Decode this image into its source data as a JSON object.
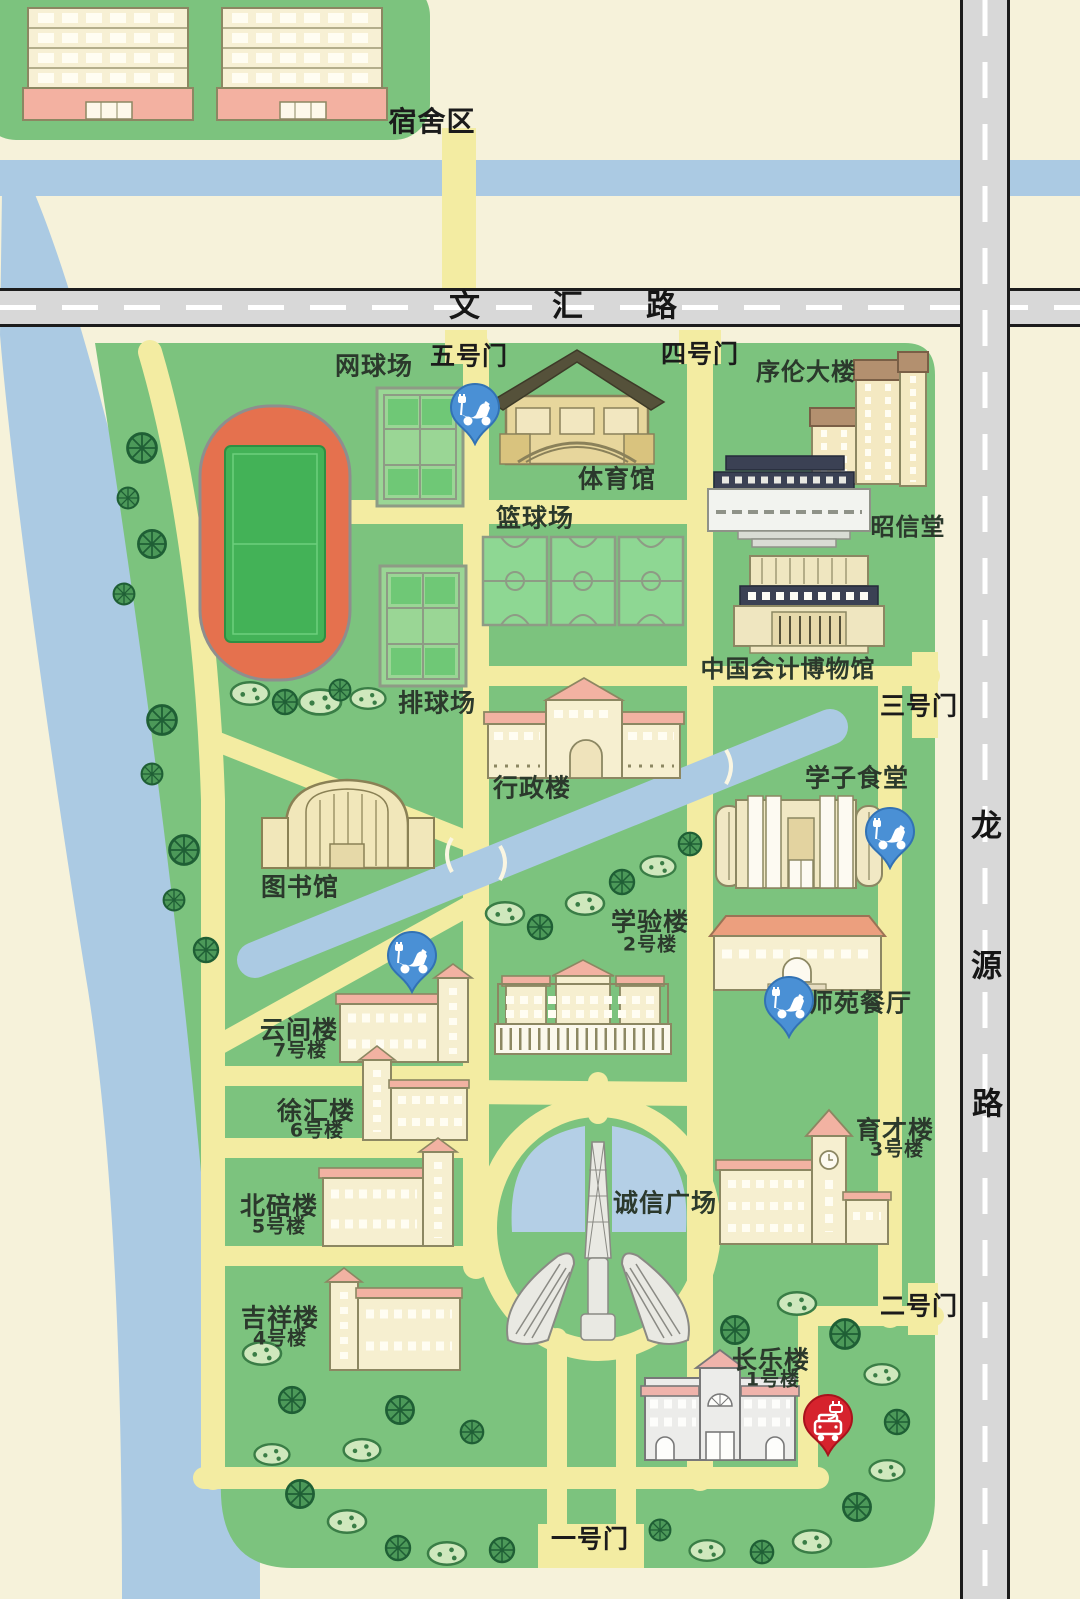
{
  "map": {
    "kind": "campus-map",
    "campus_sections": [
      "宿舍区"
    ],
    "roads": {
      "horizontal": "文汇路",
      "vertical": "龙源路"
    },
    "gates": [
      "一号门",
      "二号门",
      "三号门",
      "四号门",
      "五号门"
    ],
    "sports": [
      "网球场",
      "体育馆",
      "篮球场",
      "排球场"
    ],
    "buildings": [
      "序伦大楼",
      "昭信堂",
      "中国会计博物馆",
      "行政楼",
      "学子食堂",
      "图书馆",
      "学验楼 2号楼",
      "师苑餐厅",
      "云间楼 7号楼",
      "徐汇楼 6号楼",
      "北碚楼 5号楼",
      "吉祥楼 4号楼",
      "育才楼 3号楼",
      "诚信广场",
      "长乐楼 1号楼"
    ]
  },
  "colors": {
    "background_cream": "#f6f2da",
    "campus_green": "#7cc37e",
    "path_yellow": "#f3eca2",
    "river_blue": "#abcae3",
    "road_gray": "#d8d8d8",
    "road_border": "#1c1c1c",
    "track_orange": "#e5714e",
    "field_green": "#43b257",
    "court_green": "#9ad695",
    "building_cream": "#f6efd0",
    "roof_pink": "#f2b2a2",
    "roof_navy": "#3b4154",
    "pin_blue": "#4a90d5",
    "pin_red": "#d6232d",
    "label_color": "#2b392c"
  },
  "labels": [
    {
      "id": "dorm-area",
      "text": "宿舍区",
      "x": 432,
      "y": 122,
      "size": 28,
      "color": "#1b1b1b"
    },
    {
      "id": "road-wenhui-1",
      "text": "文",
      "x": 465,
      "y": 307,
      "size": 31,
      "color": "#161616"
    },
    {
      "id": "road-wenhui-2",
      "text": "汇",
      "x": 568,
      "y": 307,
      "size": 31,
      "color": "#161616"
    },
    {
      "id": "road-wenhui-3",
      "text": "路",
      "x": 662,
      "y": 307,
      "size": 31,
      "color": "#161616"
    },
    {
      "id": "road-longyuan-1",
      "text": "龙",
      "x": 987,
      "y": 827,
      "size": 31,
      "color": "#161616"
    },
    {
      "id": "road-longyuan-2",
      "text": "源",
      "x": 987,
      "y": 967,
      "size": 31,
      "color": "#161616"
    },
    {
      "id": "road-longyuan-3",
      "text": "路",
      "x": 988,
      "y": 1105,
      "size": 31,
      "color": "#161616"
    },
    {
      "id": "gate-5",
      "text": "五号门",
      "x": 469,
      "y": 356,
      "size": 25,
      "color": "#1b1b1b"
    },
    {
      "id": "gate-4",
      "text": "四号门",
      "x": 700,
      "y": 354,
      "size": 25,
      "color": "#1b1b1b"
    },
    {
      "id": "gate-3",
      "text": "三号门",
      "x": 919,
      "y": 706,
      "size": 25,
      "color": "#1b1b1b"
    },
    {
      "id": "gate-2",
      "text": "二号门",
      "x": 919,
      "y": 1306,
      "size": 25,
      "color": "#1b1b1b"
    },
    {
      "id": "gate-1",
      "text": "一号门",
      "x": 590,
      "y": 1539,
      "size": 25,
      "color": "#1b1b1b"
    },
    {
      "id": "tennis-courts",
      "text": "网球场",
      "x": 374,
      "y": 366,
      "size": 25
    },
    {
      "id": "gymnasium",
      "text": "体育馆",
      "x": 617,
      "y": 479,
      "size": 25
    },
    {
      "id": "basketball-courts",
      "text": "篮球场",
      "x": 535,
      "y": 518,
      "size": 25
    },
    {
      "id": "volleyball-courts",
      "text": "排球场",
      "x": 437,
      "y": 703,
      "size": 25
    },
    {
      "id": "xulun-building",
      "text": "序伦大楼",
      "x": 806,
      "y": 372,
      "size": 24
    },
    {
      "id": "zhaoxin-hall",
      "text": "昭信堂",
      "x": 908,
      "y": 527,
      "size": 24
    },
    {
      "id": "accounting-museum",
      "text": "中国会计博物馆",
      "x": 788,
      "y": 669,
      "size": 24
    },
    {
      "id": "admin-building",
      "text": "行政楼",
      "x": 532,
      "y": 788,
      "size": 25
    },
    {
      "id": "xuezi-canteen",
      "text": "学子食堂",
      "x": 857,
      "y": 778,
      "size": 25
    },
    {
      "id": "library",
      "text": "图书馆",
      "x": 300,
      "y": 887,
      "size": 25
    },
    {
      "id": "xueyan-building",
      "text": "学验楼",
      "x": 650,
      "y": 922,
      "size": 25
    },
    {
      "id": "xueyan-no",
      "text": "2号楼",
      "x": 650,
      "y": 945,
      "size": 19
    },
    {
      "id": "shiyuan-restaurant",
      "text": "师苑餐厅",
      "x": 860,
      "y": 1003,
      "size": 25
    },
    {
      "id": "yunjian-building",
      "text": "云间楼",
      "x": 299,
      "y": 1030,
      "size": 25
    },
    {
      "id": "yunjian-no",
      "text": "7号楼",
      "x": 300,
      "y": 1051,
      "size": 19
    },
    {
      "id": "xuhui-building",
      "text": "徐汇楼",
      "x": 316,
      "y": 1111,
      "size": 25
    },
    {
      "id": "xuhui-no",
      "text": "6号楼",
      "x": 317,
      "y": 1131,
      "size": 19
    },
    {
      "id": "beibei-building",
      "text": "北碚楼",
      "x": 279,
      "y": 1206,
      "size": 25
    },
    {
      "id": "beibei-no",
      "text": "5号楼",
      "x": 279,
      "y": 1227,
      "size": 19
    },
    {
      "id": "jixiang-building",
      "text": "吉祥楼",
      "x": 280,
      "y": 1318,
      "size": 25
    },
    {
      "id": "jixiang-no",
      "text": "4号楼",
      "x": 280,
      "y": 1339,
      "size": 19
    },
    {
      "id": "yucai-building",
      "text": "育才楼",
      "x": 895,
      "y": 1130,
      "size": 25
    },
    {
      "id": "yucai-no",
      "text": "3号楼",
      "x": 897,
      "y": 1150,
      "size": 19
    },
    {
      "id": "chengxin-square",
      "text": "诚信广场",
      "x": 665,
      "y": 1203,
      "size": 25
    },
    {
      "id": "changle-building",
      "text": "长乐楼",
      "x": 771,
      "y": 1360,
      "size": 25
    },
    {
      "id": "changle-no",
      "text": "1号楼",
      "x": 773,
      "y": 1380,
      "size": 19
    }
  ],
  "pins": [
    {
      "type": "scooter",
      "x": 475,
      "y": 408
    },
    {
      "type": "scooter",
      "x": 890,
      "y": 832
    },
    {
      "type": "scooter",
      "x": 412,
      "y": 956
    },
    {
      "type": "scooter",
      "x": 789,
      "y": 1001
    },
    {
      "type": "car",
      "x": 828,
      "y": 1419
    }
  ]
}
